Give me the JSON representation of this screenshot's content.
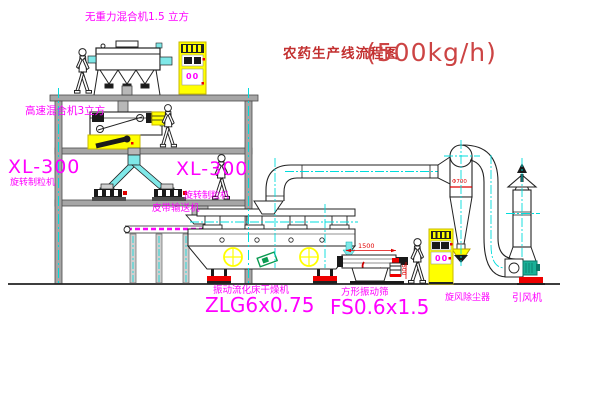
{
  "title": {
    "name": "农药生产线流程图",
    "capacity": "(500kg/h)"
  },
  "equipment_labels": {
    "gravity_mixer": "无重力混合机1.5 立方",
    "high_speed_mixer": "高速混合机3立方",
    "granulator_left_model": "XL-300",
    "granulator_left_name": "旋转制粒机",
    "granulator_right_model": "XL-300",
    "granulator_right_name": "旋转制粒机",
    "belt_conveyor": "皮带输送机",
    "fluid_bed_dryer_name": "振动流化床干燥机",
    "fluid_bed_dryer_model": "ZLG6x0.75",
    "vibrating_sieve_name": "方形振动筛",
    "vibrating_sieve_model": "FS0.6x1.5",
    "cyclone": "旋风除尘器",
    "draft_fan": "引风机"
  },
  "dimensions": {
    "sieve_length": "1500",
    "sieve_height": "500",
    "cyclone_diameter": "Φ700"
  },
  "cabinet_display": "00",
  "colors": {
    "label_magenta": "#ff00ff",
    "title_red": "#c22f2f",
    "machine_yellow": "#ffff00",
    "centerline_cyan": "#00dcdc",
    "chute_cyan": "#7fe8e8",
    "line_black": "#1a1a1a",
    "structure_gray": "#a6a6a6",
    "accent_red": "#ee0000",
    "motor_green": "#0a9a50",
    "fan_motor_teal": "#19b097"
  }
}
